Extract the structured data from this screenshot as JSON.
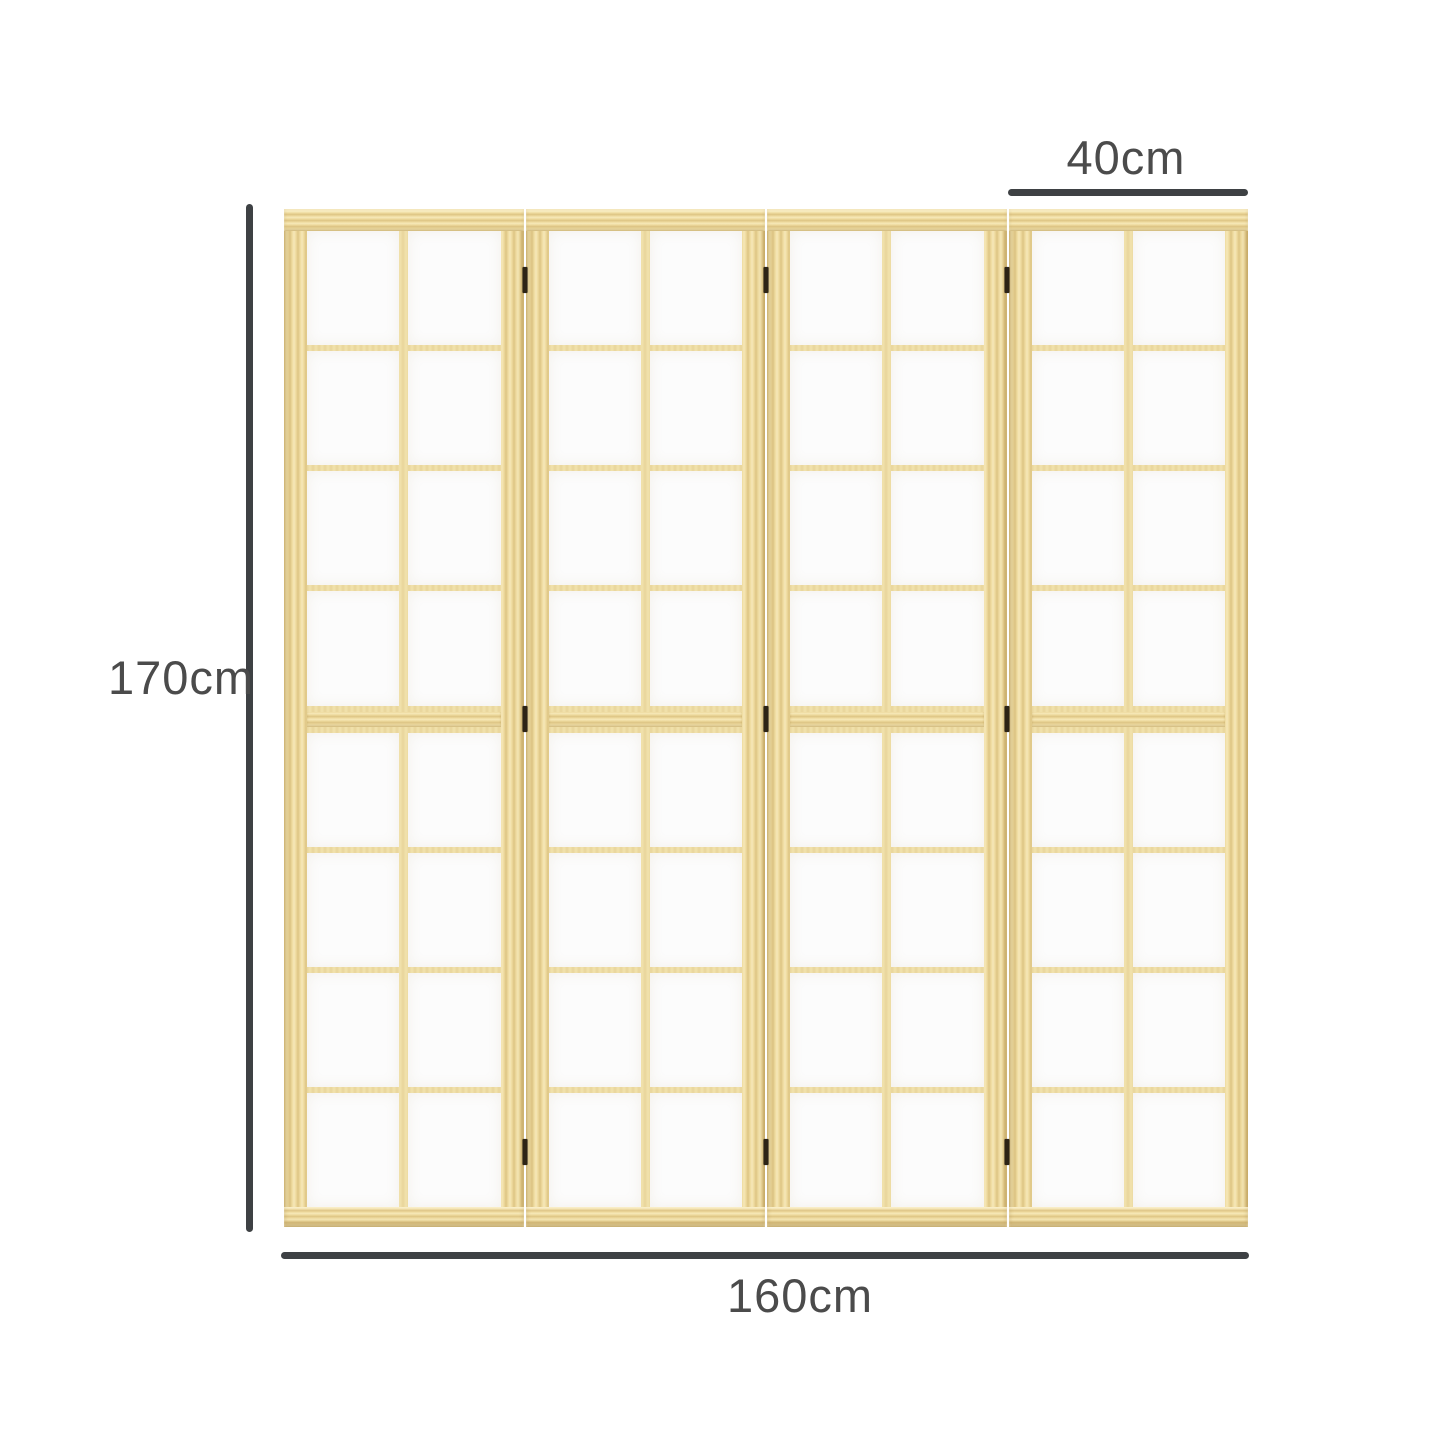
{
  "dimensions": {
    "height_label": "170cm",
    "width_label": "160cm",
    "panel_width_label": "40cm"
  },
  "divider": {
    "panel_count": 4,
    "grid_columns": 2,
    "grid_rows": 8,
    "hinges_per_junction": 3,
    "colors": {
      "wood_light": "#f6e8b8",
      "wood_mid": "#eeda9e",
      "wood_dark": "#ddc484",
      "muntin": "#e9d59b",
      "paper": "#fcfcfc",
      "hinge": "#2d2416",
      "dimension_line": "#3e4144",
      "dimension_text": "#4b4b4b"
    }
  }
}
